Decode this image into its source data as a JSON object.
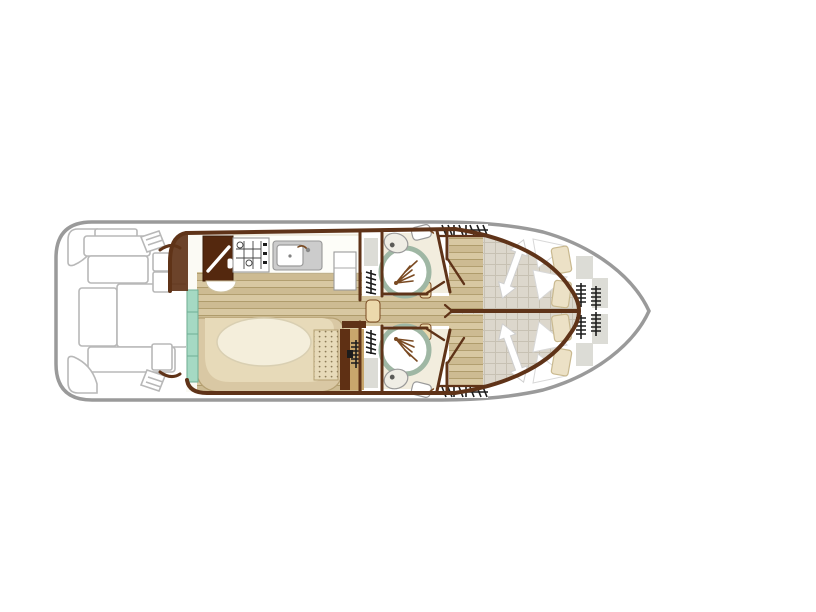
{
  "title": "boat-deck-floor-plan",
  "palette": {
    "hull_stroke": "#9a9a9a",
    "wall": "#5f3318",
    "wood1": "#d8c8a2",
    "wood2": "#cdbb92",
    "wood_line": "#a6915f",
    "carpet": "#dcd7cc",
    "carpet_line": "#c7c1b3",
    "bath_floor": "#f2edde",
    "teal": "#a5d9c3",
    "teal_line": "#6fae96",
    "bench": "#d9c8a4",
    "bench_inner": "#e7dab9",
    "bench_line": "#b6a173",
    "table": "#f4eedb",
    "cooler": "#54280e",
    "door_tan": "#ecd9ac",
    "gray_item": "#dcdcd6",
    "icon_black": "#1c1c1c",
    "outdoor_stroke": "#b8b8b8",
    "shower_ring": "#9fb7a4",
    "fixture_stroke": "#9a9a9a",
    "cushion": "#ece1c6",
    "cushion_line": "#c9b98f"
  },
  "plan": {
    "vessel": "canal-cruiser top view, bow right, stern left",
    "areas": [
      {
        "name": "aft-deck",
        "features": [
          "corner-bench-port",
          "corner-bench-starboard",
          "bench-seats",
          "sun-pads",
          "boarding-steps"
        ]
      },
      {
        "name": "galley",
        "features": [
          "cool-box-cabinet",
          "hob-4-burner",
          "sink-unit",
          "counter",
          "fridge",
          "wash-bowl"
        ]
      },
      {
        "name": "saloon-dinette",
        "features": [
          "u-shaped-bench",
          "oval-table",
          "sideboard-teal-sliding-door",
          "heater",
          "step-area"
        ]
      },
      {
        "name": "corridor",
        "features": [
          "sliding-door",
          "wardrobe-shelves-port",
          "wardrobe-shelves-starboard"
        ]
      },
      {
        "name": "bathroom-port",
        "features": [
          "round-shower",
          "toilet",
          "washbasin",
          "door"
        ]
      },
      {
        "name": "bathroom-starboard",
        "features": [
          "round-shower",
          "toilet",
          "washbasin",
          "door"
        ]
      },
      {
        "name": "cabin-port",
        "features": [
          "double-bed",
          "bed-direction-arrow",
          "pillows",
          "cushions",
          "hanging-wardrobe",
          "door"
        ]
      },
      {
        "name": "cabin-starboard",
        "features": [
          "double-bed",
          "bed-direction-arrow",
          "pillows",
          "cushions",
          "hanging-wardrobe",
          "door"
        ]
      },
      {
        "name": "bow-deck",
        "features": [
          "shelf-lockers",
          "ladder-steps"
        ]
      }
    ],
    "counts": {
      "cabins": 2,
      "bathrooms": 2,
      "showers": 2,
      "toilets": 2,
      "double_beds": 2
    }
  }
}
